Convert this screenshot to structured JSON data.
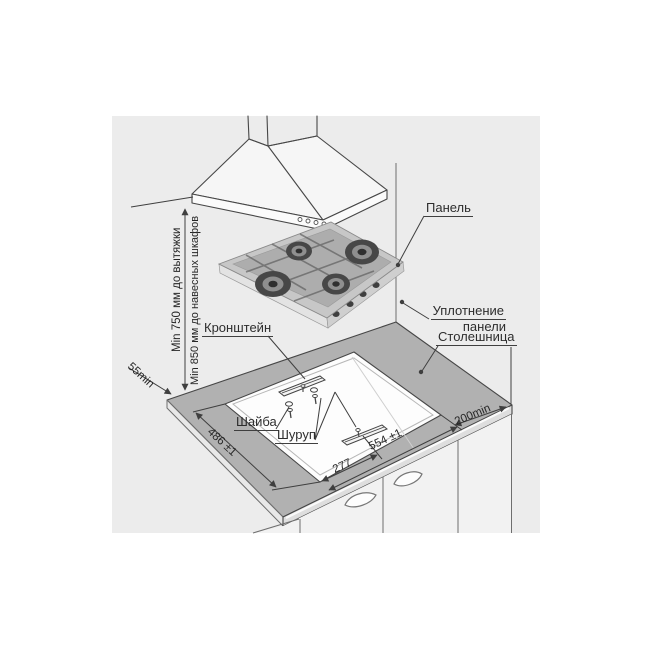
{
  "diagram": {
    "title_note": "gas hob installation diagram",
    "colors": {
      "paper_background": "#ececec",
      "line": "#474747",
      "countertop_fill": "#b1b1b1",
      "cutout_fill": "#fdfdfd",
      "text": "#2d2d2d"
    },
    "labels": {
      "panel": "Панель",
      "panel_seal_line1": "Уплотнение",
      "panel_seal_line2": "панели",
      "countertop": "Столешница",
      "bracket": "Кронштейн",
      "washer": "Шайба",
      "screw": "Шуруп"
    },
    "dimensions": {
      "hood_clearance": "Min 750 мм до вытяжки",
      "wall_cabinet_clearance": "Min 850 мм до навесных шкафов",
      "back_edge_clearance": "55min",
      "cutout_depth": "486 ±1",
      "cutout_width": "554 ±1",
      "bracket_offset": "277",
      "side_clearance": "200min"
    }
  }
}
